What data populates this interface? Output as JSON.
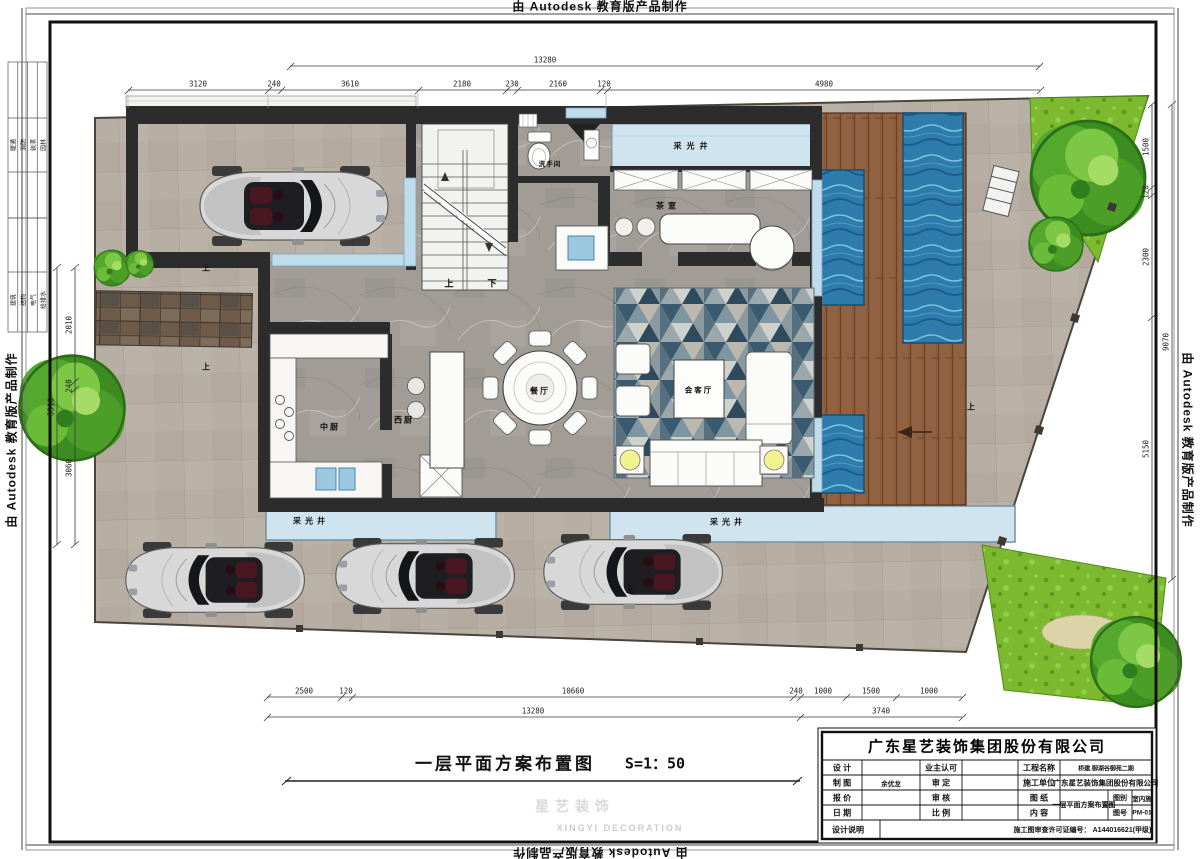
{
  "stamp": {
    "text": "由 Autodesk 教育版产品制作"
  },
  "signoff": {
    "table1": [
      "暖通",
      "消防",
      "装潢",
      "园林"
    ],
    "table2": [
      "建筑",
      "结构",
      "电气",
      "给排水"
    ]
  },
  "plan": {
    "title": "一层平面方案布置图",
    "scale": "S=1：50",
    "rooms": {
      "dining": "餐厅",
      "living": "会客厅",
      "kitchen_cn": "中厨",
      "kitchen_west": "西厨",
      "tea_room": "茶室",
      "bathroom": "洗手间"
    },
    "lightwell": "采光井",
    "up": "上",
    "down": "下"
  },
  "dims": {
    "top": {
      "total": "13280",
      "segments": [
        "3120",
        "240",
        "3610",
        "2180",
        "230",
        "2160",
        "120",
        "4980"
      ]
    },
    "bottom": {
      "segments": [
        "2500",
        "120",
        "10660",
        "240",
        "1000",
        "1500",
        "1000"
      ],
      "total_left": "13280",
      "total_right": "3740"
    },
    "left": {
      "segments": [
        "2010",
        "240",
        "3060"
      ],
      "total": "5310"
    },
    "right": {
      "segments": [
        "1500",
        "120",
        "2300"
      ],
      "lower": "5150",
      "total": "9070"
    }
  },
  "titleblock": {
    "company": "广东星艺装饰集团股份有限公司",
    "labels": {
      "design": "设 计",
      "owner_approve": "业主认可",
      "project_name": "工程名称",
      "draft": "制 图",
      "approve": "审 定",
      "contractor": "施工单位",
      "quote": "报 价",
      "review": "审 核",
      "drawing": "图 纸",
      "date": "日 期",
      "ratio": "比 例",
      "content": "内 容",
      "design_note": "设计说明",
      "category": "图别",
      "number": "图号",
      "license": "施工图审查许可证编号："
    },
    "values": {
      "draft": "余优龙",
      "project_name": "桥建.御湖谷御苑二期",
      "contractor": "广东星艺装饰集团股份有限公司",
      "drawing_content": "一层平面方案布置图",
      "category": "室内施",
      "number": "PM-01",
      "license": "A144016621(甲级)"
    }
  },
  "watermark": {
    "cn": "星艺装饰",
    "en": "XINGYI DECORATION"
  },
  "colors": {
    "paving": "#b7aea4",
    "marble": "#a19c96",
    "wall": "#2c2c2c",
    "lightwell": "#cfe4ee",
    "water": "#2d7cab",
    "deck": "#8a5a39",
    "lawn": "#7cb92f",
    "accent_yellow": "#f2f28e"
  }
}
